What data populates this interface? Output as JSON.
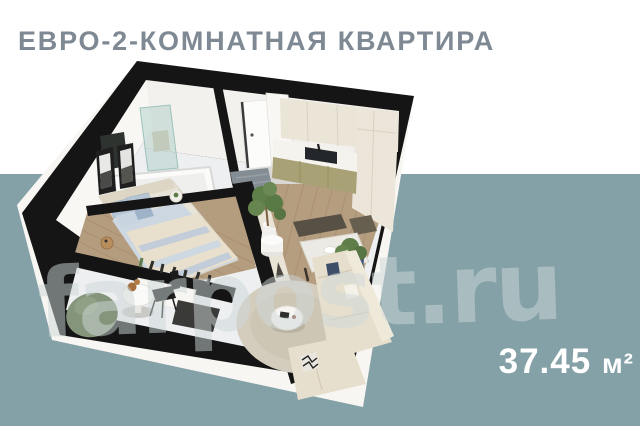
{
  "header": {
    "title": "ЕВРО-2-КОМНАТНАЯ КВАРТИРА"
  },
  "footer": {
    "area_value": "37.45",
    "area_unit": "м²"
  },
  "watermark": {
    "text": "farpost.ru"
  },
  "palette": {
    "background_top": "#ffffff",
    "background_bottom": "#85a1a8",
    "title_color": "#7e8993",
    "area_text_color": "#ffffff",
    "walls_black": "#151515",
    "outer_wall_white": "#f7f6f2",
    "wood_floor": "#b59d80",
    "tile_floor": "#edeff0",
    "kitchen_cabinet_olive": "#a9a176",
    "kitchen_cabinet_cream": "#ebe5d8",
    "sofa_cream": "#e6dfce",
    "bedding_blue": "#b6c6d6",
    "beanbag_green": "#84957b"
  },
  "floorplan": {
    "kind": "isometric-3d-apartment-render",
    "rooms": [
      "bathroom",
      "hallway",
      "kitchen",
      "bedroom",
      "lounge-corner",
      "dining-area",
      "living-area"
    ]
  }
}
